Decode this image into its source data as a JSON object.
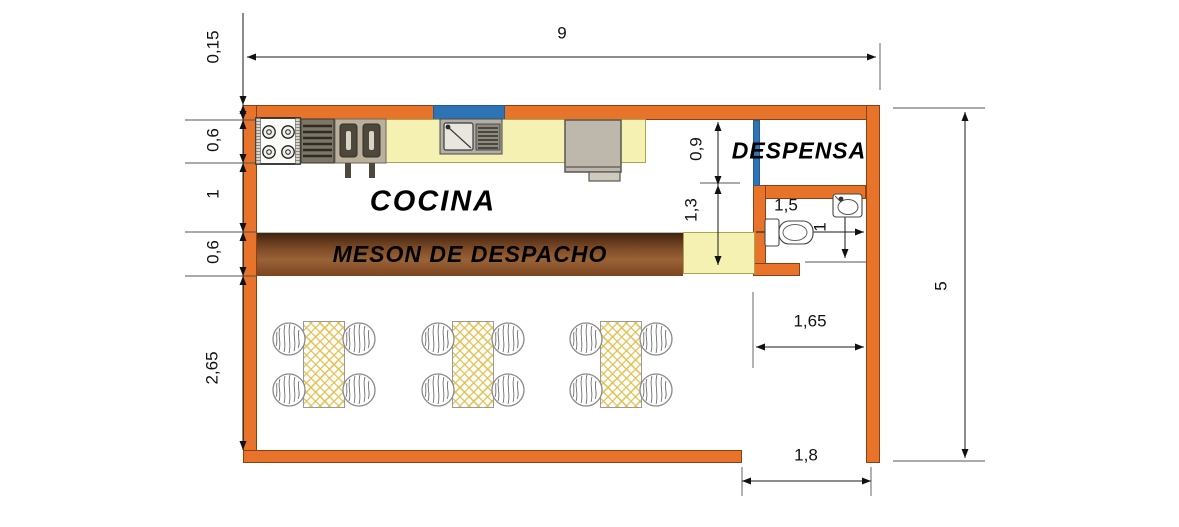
{
  "rooms": {
    "kitchen_label": "COCINA",
    "pantry_label": "DESPENSA",
    "serving_counter_label": "MESON DE DESPACHO"
  },
  "dimensions": {
    "total_width": "9",
    "wall_thickness": "0,15",
    "counter_depth": "0,6",
    "kitchen_aisle_depth": "1",
    "serving_counter_depth": "0,6",
    "dining_depth": "2,65",
    "pantry_depth": "0,9",
    "pantry_to_counter": "1,3",
    "toilet_length": "1,5",
    "bathroom_inner": "1",
    "bathroom_width": "1,65",
    "total_height": "5",
    "door_opening_width": "1,8"
  },
  "colors": {
    "wall": "#E8732B",
    "window_door": "#2E74B5",
    "counter": "#F5F1B3",
    "meson_dark": "#3F240E",
    "meson_mid": "#9A6238",
    "table_hatch": "#E3BE4C"
  },
  "fixtures": [
    "stove",
    "grill",
    "double-fryer",
    "kitchen-sink",
    "refrigerator",
    "window",
    "pantry-door",
    "toilet",
    "washbasin",
    "dining-table",
    "chair"
  ]
}
